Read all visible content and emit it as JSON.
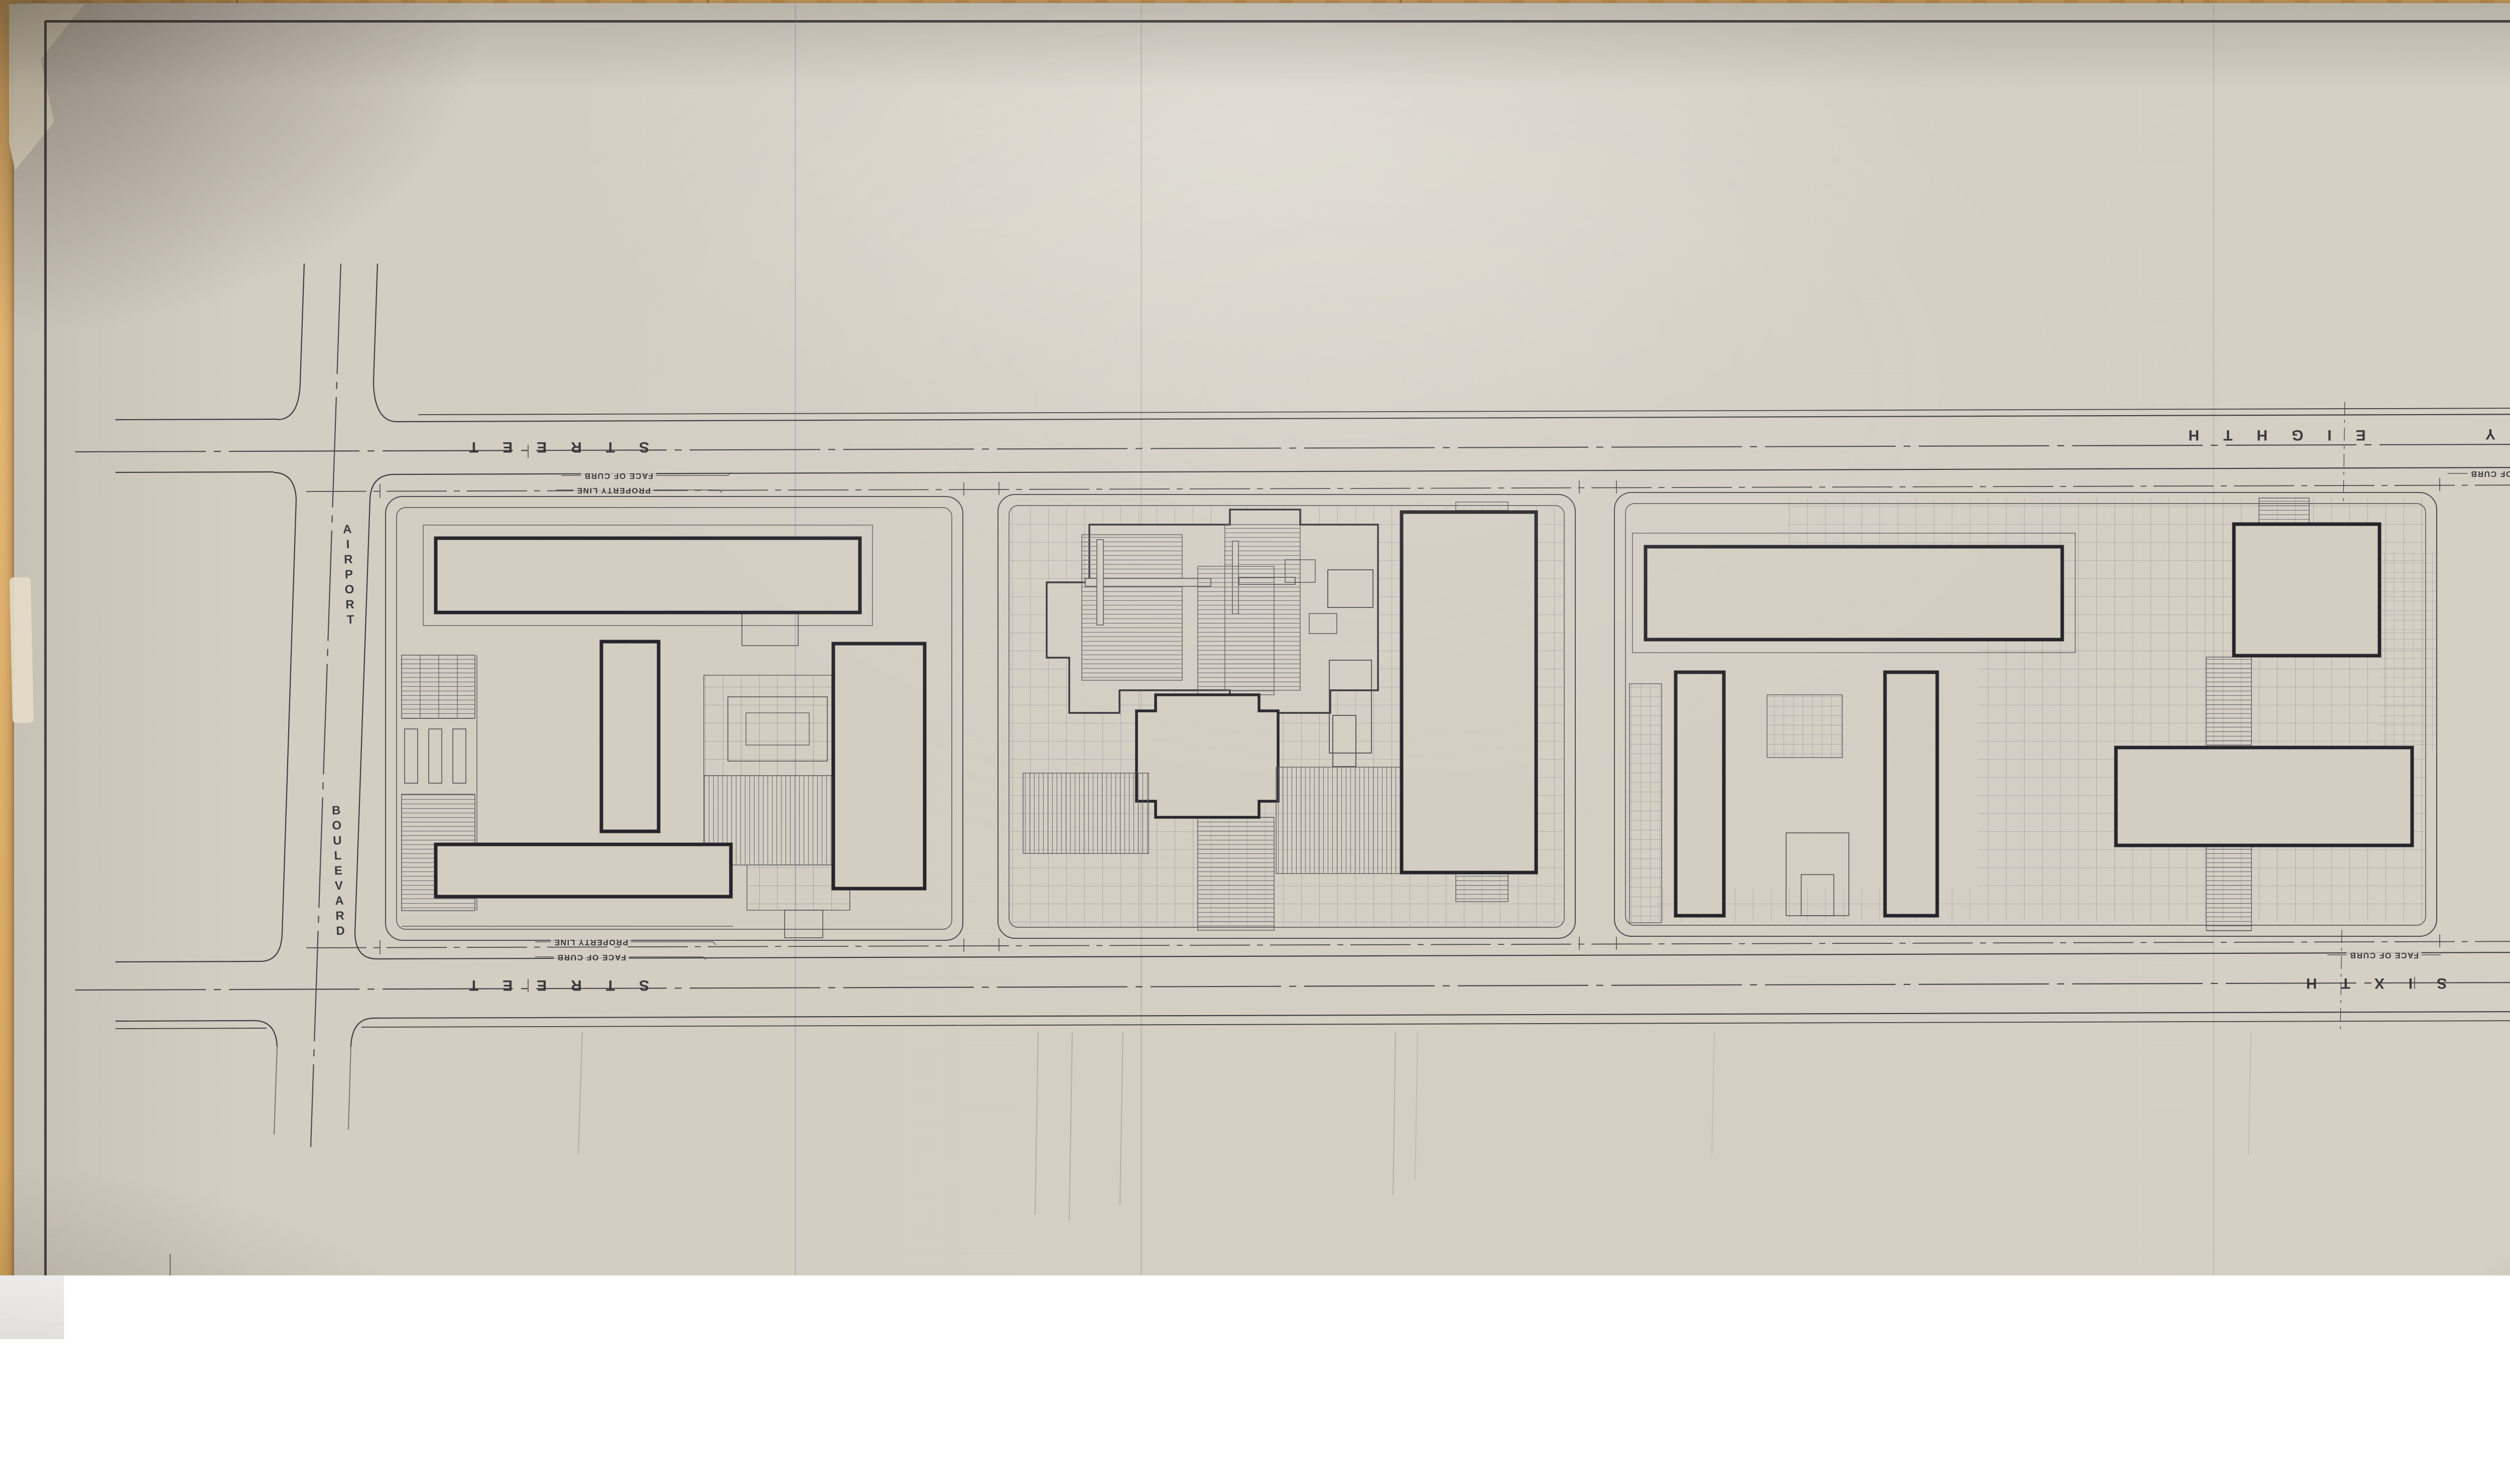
{
  "plan": {
    "title_hint": "Site plan of three blocks",
    "streets": {
      "top": {
        "name_word1": "NINETY",
        "name_word2": "EIGHTH",
        "suffix": "STREET"
      },
      "bottom": {
        "name_word1": "NINETY",
        "name_word2": "SIXTH",
        "suffix": "STREET"
      },
      "left": {
        "name": "AIRPORT",
        "suffix": "BOULEVARD"
      },
      "right": {
        "name": "VICKSBURG",
        "suffix": "AVENUE"
      }
    },
    "annotations": {
      "face_of_curb": "FACE OF CURB",
      "property_line": "PROPERTY LINE"
    },
    "compass": {
      "letter": "N"
    },
    "colors": {
      "paper": "#d3cdc2",
      "ink_thin": "#4a4950",
      "ink_medium": "#3b3a40",
      "ink_building": "#26252b",
      "wood": "#d8a55f",
      "compass_fill": "#19181c"
    }
  }
}
